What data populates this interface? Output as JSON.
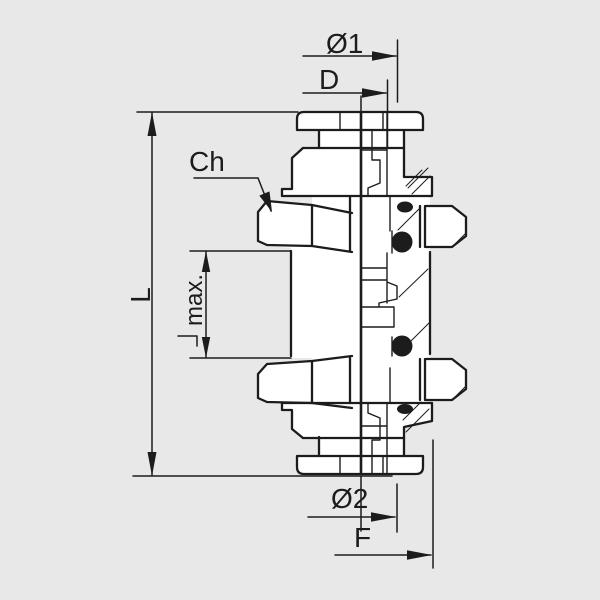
{
  "colors": {
    "background": "#e8e8e8",
    "line": "#1c1c1c",
    "fill": "#ffffff",
    "text": "#1c1c1c"
  },
  "labels": {
    "outer_diameter_top": "Ø1",
    "tube_diameter": "D",
    "hex_size": "Ch",
    "overall_length": "L",
    "panel_max_thickness": "max.",
    "outer_diameter_bottom": "Ø2",
    "thread_length": "F"
  }
}
